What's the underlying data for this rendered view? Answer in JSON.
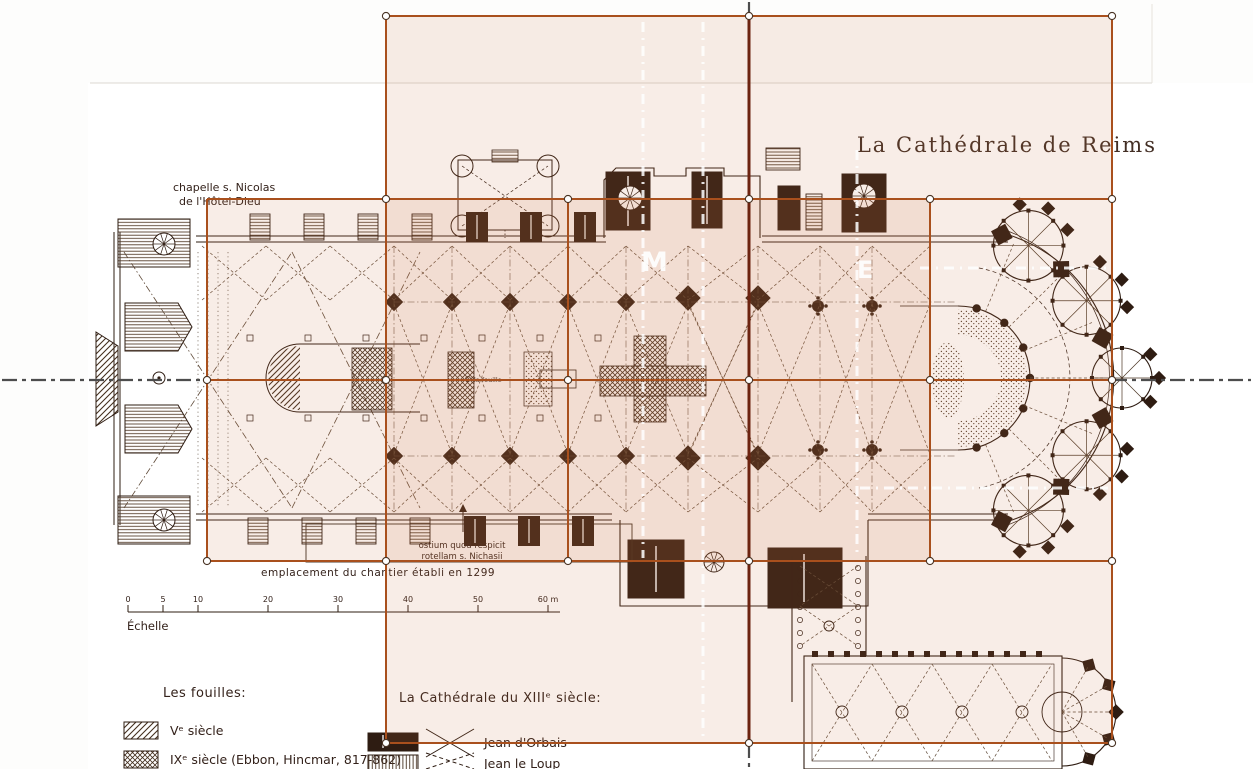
{
  "title": "La Cathédrale de Reims",
  "annotations": {
    "chapelle": [
      "chapelle s. Nicolas",
      "de l'Hôtel-Dieu"
    ],
    "ostium": [
      "ostium quod respicit",
      "rotellam s. Nichasii"
    ],
    "chantier": "emplacement du chantier établi en 1299",
    "fouille_marker": "la fouille"
  },
  "plan_letters": {
    "m": "M",
    "e": "E"
  },
  "scale_bar": {
    "label": "Échelle",
    "ticks": [
      {
        "label": "0",
        "x": 128
      },
      {
        "label": "5",
        "x": 163
      },
      {
        "label": "10",
        "x": 198
      },
      {
        "label": "20",
        "x": 268
      },
      {
        "label": "30",
        "x": 338
      },
      {
        "label": "40",
        "x": 408
      },
      {
        "label": "50",
        "x": 478
      },
      {
        "label": "60 m",
        "x": 548
      }
    ]
  },
  "legend_fouilles": {
    "heading": "Les fouilles:",
    "items": [
      {
        "swatch": "diagonal-hatch",
        "label": "Vᵉ siècle"
      },
      {
        "swatch": "cross-hatch",
        "label": "IXᵉ siècle (Ebbon, Hincmar, 817-862)"
      }
    ]
  },
  "legend_cathedrale": {
    "heading": "La Cathédrale du XIIIᵉ siècle:",
    "items": [
      {
        "swatch": "solid-dark",
        "symbol": "x-cross",
        "label": "Jean d'Orbais"
      },
      {
        "swatch": "vertical-hatch",
        "symbol": "dashed-x-cross",
        "label": "Jean le Loup"
      }
    ]
  },
  "overlay": {
    "grid_color": "#a9501d",
    "axis_color": "#6c2310",
    "centerline_color": "#4d4d4d",
    "white_guide_color": "#ffffff",
    "tint_fill": "rgba(199,118,70,0.13)",
    "tint_rects": [
      {
        "x": 386,
        "y": 16,
        "w": 726,
        "h": 727
      },
      {
        "x": 207,
        "y": 199,
        "w": 723,
        "h": 362
      }
    ],
    "h_lines": [
      {
        "y": 16,
        "x1": 386,
        "x2": 1112
      },
      {
        "y": 199,
        "x1": 207,
        "x2": 1112
      },
      {
        "y": 380,
        "x1": 207,
        "x2": 1112
      },
      {
        "y": 561,
        "x1": 207,
        "x2": 1112
      },
      {
        "y": 743,
        "x1": 386,
        "x2": 1112
      }
    ],
    "v_lines": [
      {
        "x": 207,
        "y1": 199,
        "y2": 561
      },
      {
        "x": 386,
        "y1": 16,
        "y2": 743
      },
      {
        "x": 568,
        "y1": 199,
        "y2": 561
      },
      {
        "x": 930,
        "y1": 199,
        "y2": 561
      },
      {
        "x": 1112,
        "y1": 16,
        "y2": 743
      }
    ],
    "axis_v": {
      "x": 749,
      "y1": 16,
      "y2": 743
    },
    "centerline_h": [
      {
        "y": 380,
        "x1": 2,
        "x2": 207
      },
      {
        "y": 380,
        "x1": 1112,
        "x2": 1251
      }
    ],
    "centerline_v": [
      {
        "x": 749,
        "y1": 2,
        "y2": 16
      },
      {
        "x": 749,
        "y1": 743,
        "y2": 767
      }
    ],
    "white_guides_v": [
      {
        "x": 643,
        "y1": 22,
        "y2": 558
      },
      {
        "x": 703,
        "y1": 22,
        "y2": 740
      },
      {
        "x": 857,
        "y1": 150,
        "y2": 558
      }
    ],
    "white_guides_h": [
      {
        "y": 268,
        "x1": 920,
        "x2": 1108
      },
      {
        "y": 488,
        "x1": 860,
        "x2": 1108
      }
    ],
    "handles": [
      [
        386,
        16
      ],
      [
        749,
        16
      ],
      [
        1112,
        16
      ],
      [
        386,
        199
      ],
      [
        568,
        199
      ],
      [
        749,
        199
      ],
      [
        930,
        199
      ],
      [
        1112,
        199
      ],
      [
        207,
        380
      ],
      [
        386,
        380
      ],
      [
        568,
        380
      ],
      [
        749,
        380
      ],
      [
        930,
        380
      ],
      [
        1112,
        380
      ],
      [
        207,
        561
      ],
      [
        386,
        561
      ],
      [
        568,
        561
      ],
      [
        749,
        561
      ],
      [
        930,
        561
      ],
      [
        1112,
        561
      ],
      [
        386,
        743
      ],
      [
        749,
        743
      ],
      [
        1112,
        743
      ]
    ]
  }
}
